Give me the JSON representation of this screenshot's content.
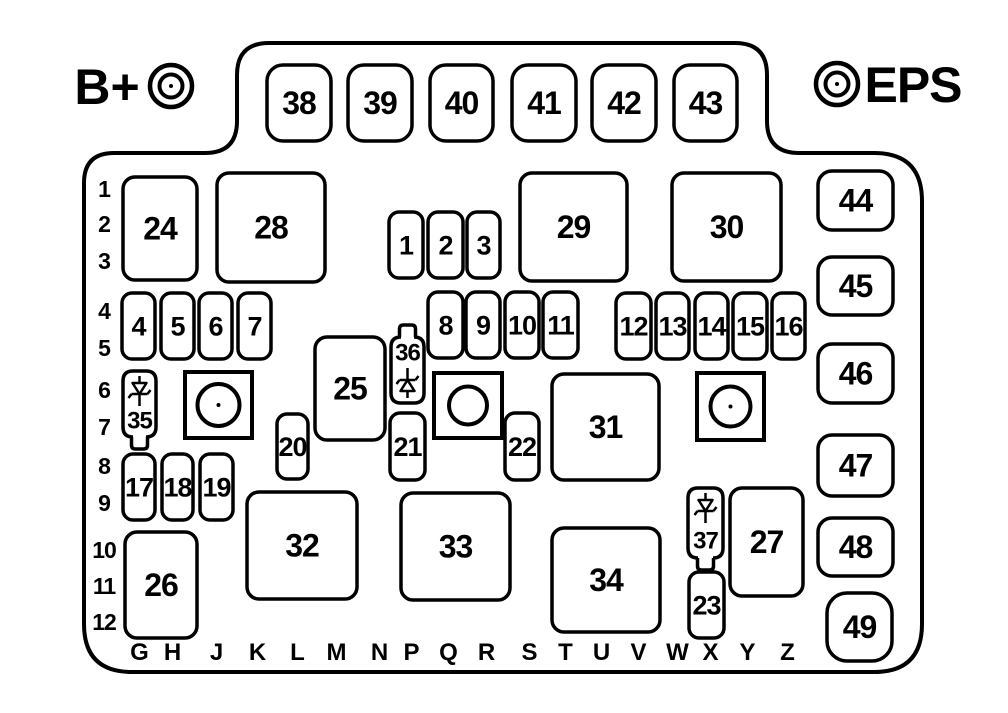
{
  "colors": {
    "ink": "#000000",
    "paper": "#ffffff"
  },
  "terminals": {
    "left": {
      "label": "B+",
      "text_x": 107,
      "text_y": 104,
      "cx": 171,
      "cy": 86
    },
    "right": {
      "label": "EPS",
      "text_x": 913,
      "text_y": 102,
      "cx": 837,
      "cy": 84
    }
  },
  "fuses": [
    {
      "n": "38",
      "x": 267,
      "y": 65,
      "w": 64,
      "h": 76,
      "r": 16,
      "fs": 32
    },
    {
      "n": "39",
      "x": 348,
      "y": 65,
      "w": 64,
      "h": 76,
      "r": 16,
      "fs": 32
    },
    {
      "n": "40",
      "x": 430,
      "y": 65,
      "w": 63,
      "h": 76,
      "r": 16,
      "fs": 32
    },
    {
      "n": "41",
      "x": 512,
      "y": 65,
      "w": 64,
      "h": 76,
      "r": 16,
      "fs": 32
    },
    {
      "n": "42",
      "x": 592,
      "y": 65,
      "w": 64,
      "h": 76,
      "r": 16,
      "fs": 32
    },
    {
      "n": "43",
      "x": 674,
      "y": 65,
      "w": 63,
      "h": 76,
      "r": 16,
      "fs": 32
    },
    {
      "n": "44",
      "x": 818,
      "y": 171,
      "w": 75,
      "h": 59,
      "r": 14,
      "fs": 32
    },
    {
      "n": "45",
      "x": 818,
      "y": 257,
      "w": 75,
      "h": 58,
      "r": 14,
      "fs": 32
    },
    {
      "n": "46",
      "x": 818,
      "y": 344,
      "w": 75,
      "h": 59,
      "r": 14,
      "fs": 32
    },
    {
      "n": "47",
      "x": 818,
      "y": 435,
      "w": 75,
      "h": 61,
      "r": 14,
      "fs": 32
    },
    {
      "n": "48",
      "x": 818,
      "y": 518,
      "w": 75,
      "h": 58,
      "r": 14,
      "fs": 32
    },
    {
      "n": "49",
      "x": 827,
      "y": 593,
      "w": 65,
      "h": 68,
      "r": 20,
      "fs": 32
    },
    {
      "n": "24",
      "x": 123,
      "y": 177,
      "w": 74,
      "h": 103,
      "r": 12,
      "fs": 32
    },
    {
      "n": "28",
      "x": 217,
      "y": 173,
      "w": 108,
      "h": 109,
      "r": 12,
      "fs": 32
    },
    {
      "n": "29",
      "x": 520,
      "y": 173,
      "w": 107,
      "h": 108,
      "r": 12,
      "fs": 32
    },
    {
      "n": "30",
      "x": 672,
      "y": 173,
      "w": 109,
      "h": 108,
      "r": 12,
      "fs": 32
    },
    {
      "n": "25",
      "x": 315,
      "y": 337,
      "w": 70,
      "h": 103,
      "r": 12,
      "fs": 32
    },
    {
      "n": "31",
      "x": 552,
      "y": 374,
      "w": 107,
      "h": 106,
      "r": 12,
      "fs": 32
    },
    {
      "n": "26",
      "x": 125,
      "y": 532,
      "w": 72,
      "h": 106,
      "r": 12,
      "fs": 32
    },
    {
      "n": "32",
      "x": 247,
      "y": 492,
      "w": 110,
      "h": 107,
      "r": 12,
      "fs": 32
    },
    {
      "n": "33",
      "x": 401,
      "y": 493,
      "w": 109,
      "h": 107,
      "r": 12,
      "fs": 32
    },
    {
      "n": "34",
      "x": 552,
      "y": 528,
      "w": 108,
      "h": 104,
      "r": 12,
      "fs": 32
    },
    {
      "n": "27",
      "x": 730,
      "y": 488,
      "w": 73,
      "h": 108,
      "r": 12,
      "fs": 32
    },
    {
      "n": "1",
      "x": 389,
      "y": 212,
      "w": 34,
      "h": 66,
      "r": 10,
      "fs": 27
    },
    {
      "n": "2",
      "x": 428,
      "y": 212,
      "w": 35,
      "h": 66,
      "r": 10,
      "fs": 27
    },
    {
      "n": "3",
      "x": 467,
      "y": 212,
      "w": 33,
      "h": 66,
      "r": 10,
      "fs": 27
    },
    {
      "n": "4",
      "x": 122,
      "y": 293,
      "w": 33,
      "h": 66,
      "r": 10,
      "fs": 27
    },
    {
      "n": "5",
      "x": 161,
      "y": 293,
      "w": 33,
      "h": 66,
      "r": 10,
      "fs": 27
    },
    {
      "n": "6",
      "x": 199,
      "y": 293,
      "w": 33,
      "h": 66,
      "r": 10,
      "fs": 27
    },
    {
      "n": "7",
      "x": 238,
      "y": 293,
      "w": 33,
      "h": 66,
      "r": 10,
      "fs": 27
    },
    {
      "n": "8",
      "x": 428,
      "y": 292,
      "w": 35,
      "h": 66,
      "r": 10,
      "fs": 27
    },
    {
      "n": "9",
      "x": 466,
      "y": 292,
      "w": 34,
      "h": 66,
      "r": 10,
      "fs": 27
    },
    {
      "n": "10",
      "x": 505,
      "y": 292,
      "w": 34,
      "h": 66,
      "r": 10,
      "fs": 27
    },
    {
      "n": "11",
      "x": 543,
      "y": 292,
      "w": 35,
      "h": 66,
      "r": 10,
      "fs": 27
    },
    {
      "n": "12",
      "x": 616,
      "y": 293,
      "w": 35,
      "h": 66,
      "r": 10,
      "fs": 27
    },
    {
      "n": "13",
      "x": 656,
      "y": 293,
      "w": 33,
      "h": 66,
      "r": 10,
      "fs": 27
    },
    {
      "n": "14",
      "x": 695,
      "y": 293,
      "w": 33,
      "h": 66,
      "r": 10,
      "fs": 27
    },
    {
      "n": "15",
      "x": 733,
      "y": 293,
      "w": 34,
      "h": 66,
      "r": 10,
      "fs": 27
    },
    {
      "n": "16",
      "x": 772,
      "y": 293,
      "w": 33,
      "h": 66,
      "r": 10,
      "fs": 27
    },
    {
      "n": "17",
      "x": 123,
      "y": 454,
      "w": 32,
      "h": 66,
      "r": 10,
      "fs": 27
    },
    {
      "n": "18",
      "x": 162,
      "y": 454,
      "w": 31,
      "h": 66,
      "r": 10,
      "fs": 27
    },
    {
      "n": "19",
      "x": 200,
      "y": 454,
      "w": 33,
      "h": 66,
      "r": 10,
      "fs": 27
    },
    {
      "n": "20",
      "x": 277,
      "y": 414,
      "w": 31,
      "h": 65,
      "r": 10,
      "fs": 27
    },
    {
      "n": "21",
      "x": 390,
      "y": 413,
      "w": 35,
      "h": 67,
      "r": 10,
      "fs": 27
    },
    {
      "n": "22",
      "x": 505,
      "y": 413,
      "w": 34,
      "h": 67,
      "r": 10,
      "fs": 27
    },
    {
      "n": "23",
      "x": 689,
      "y": 572,
      "w": 35,
      "h": 66,
      "r": 10,
      "fs": 27
    }
  ],
  "relays": [
    {
      "id": "1",
      "x": 185,
      "y": 372,
      "w": 67,
      "h": 66,
      "cr": 21,
      "dot": true
    },
    {
      "id": "2",
      "x": 434,
      "y": 373,
      "w": 68,
      "h": 65,
      "cr": 19,
      "dot": false
    },
    {
      "id": "3",
      "x": 697,
      "y": 373,
      "w": 67,
      "h": 67,
      "cr": 20,
      "dot": true
    }
  ],
  "diodes": [
    {
      "n": "35",
      "x": 123,
      "y": 371,
      "w": 33,
      "h": 66,
      "notch": "bottom",
      "dir": "down",
      "glyph_cy": 391,
      "label_cy": 420
    },
    {
      "n": "36",
      "x": 391,
      "y": 337,
      "w": 33,
      "h": 66,
      "notch": "top",
      "dir": "up",
      "glyph_cy": 383,
      "label_cy": 352
    },
    {
      "n": "37",
      "x": 688,
      "y": 488,
      "w": 35,
      "h": 70,
      "notch": "bottom",
      "dir": "down",
      "glyph_cy": 508,
      "label_cy": 540
    }
  ],
  "row_labels": [
    {
      "t": "1",
      "y": 189
    },
    {
      "t": "2",
      "y": 224
    },
    {
      "t": "3",
      "y": 261
    },
    {
      "t": "4",
      "y": 311
    },
    {
      "t": "5",
      "y": 348
    },
    {
      "t": "6",
      "y": 390
    },
    {
      "t": "7",
      "y": 427
    },
    {
      "t": "8",
      "y": 466
    },
    {
      "t": "9",
      "y": 503
    },
    {
      "t": "10",
      "y": 550
    },
    {
      "t": "11",
      "y": 586
    },
    {
      "t": "12",
      "y": 622
    }
  ],
  "col_labels": [
    {
      "t": "G",
      "x": 139
    },
    {
      "t": "H",
      "x": 172
    },
    {
      "t": "J",
      "x": 216
    },
    {
      "t": "K",
      "x": 257
    },
    {
      "t": "L",
      "x": 297
    },
    {
      "t": "M",
      "x": 336
    },
    {
      "t": "N",
      "x": 379
    },
    {
      "t": "P",
      "x": 411
    },
    {
      "t": "Q",
      "x": 448
    },
    {
      "t": "R",
      "x": 486
    },
    {
      "t": "S",
      "x": 529
    },
    {
      "t": "T",
      "x": 565
    },
    {
      "t": "U",
      "x": 601
    },
    {
      "t": "V",
      "x": 638
    },
    {
      "t": "W",
      "x": 677
    },
    {
      "t": "X",
      "x": 710
    },
    {
      "t": "Y",
      "x": 747
    },
    {
      "t": "Z",
      "x": 787
    }
  ]
}
